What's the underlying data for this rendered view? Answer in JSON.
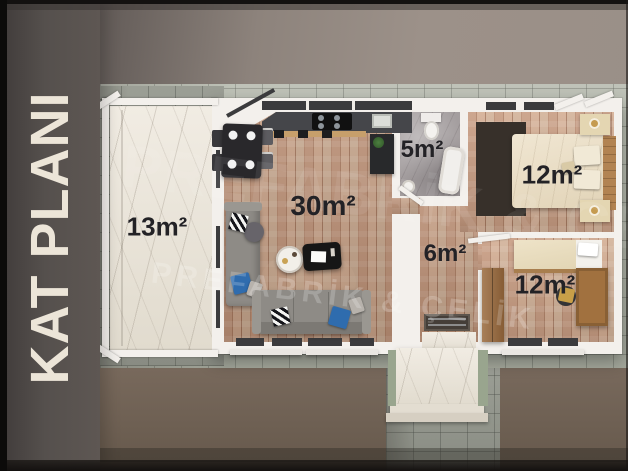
{
  "title": "KAT PLANI",
  "watermark": "PREFABRİK & ÇELİK",
  "rooms": {
    "terrace": {
      "area": "13m²"
    },
    "living_kitchen": {
      "area": "30m²"
    },
    "bathroom": {
      "area": "5m²"
    },
    "hallway": {
      "area": "6m²"
    },
    "bedroom_1": {
      "area": "12m²"
    },
    "bedroom_2": {
      "area": "12m²"
    }
  },
  "colors": {
    "accent_pillow_blue": "#2f6cae",
    "wood_floor": "#b08066",
    "terrace_marble": "#ebe5da",
    "pavement_tile": "#aeb3a8",
    "label_text": "#232226",
    "title_panel": "#57504d",
    "title_text": "#ece5d8"
  }
}
